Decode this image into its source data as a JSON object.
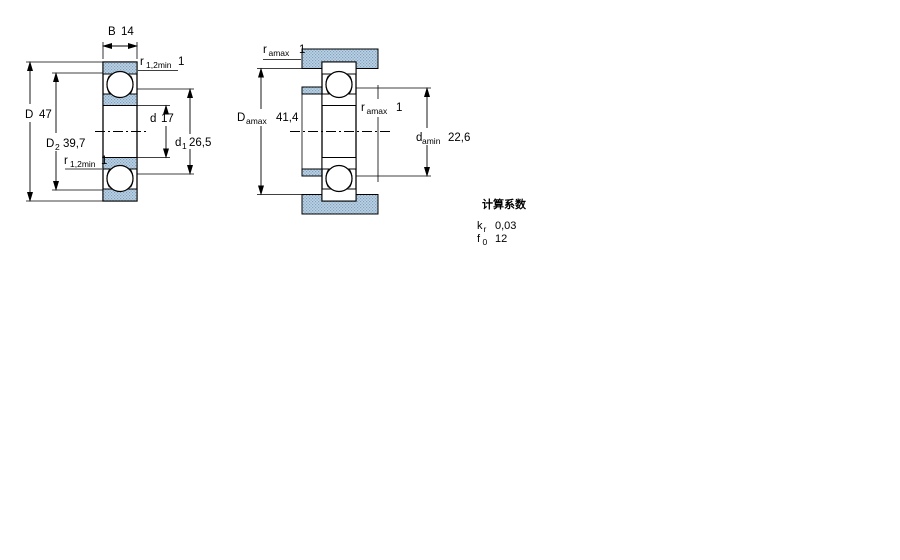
{
  "section_view": {
    "B": {
      "label": "B",
      "value": "14"
    },
    "r_top": {
      "label": "r",
      "sub": "1,2min",
      "value": "1"
    },
    "r_bottom": {
      "label": "r",
      "sub": "1,2min",
      "value": "1"
    },
    "D": {
      "label": "D",
      "value": "47"
    },
    "D2": {
      "label": "D",
      "sub": "2",
      "value": "39,7"
    },
    "d": {
      "label": "d",
      "value": "17"
    },
    "d1": {
      "label": "d",
      "sub": "1",
      "value": "26,5"
    }
  },
  "mounting_view": {
    "r_top": {
      "label": "r",
      "sub": "amax",
      "value": "1"
    },
    "r_mid": {
      "label": "r",
      "sub": "amax",
      "value": "1"
    },
    "Da": {
      "label": "D",
      "sub": "amax",
      "value": "41,4"
    },
    "da": {
      "label": "d",
      "sub": "amin",
      "value": "22,6"
    }
  },
  "calculation_factors": {
    "heading": "计算系数",
    "kr": {
      "label": "k",
      "sub": "r",
      "value": "0,03"
    },
    "f0": {
      "label": "f",
      "sub": "0",
      "value": "12"
    }
  },
  "colors": {
    "hatch_base": "#bdd2e3",
    "hatch_dot": "#7fa1c1",
    "line": "#000000"
  }
}
